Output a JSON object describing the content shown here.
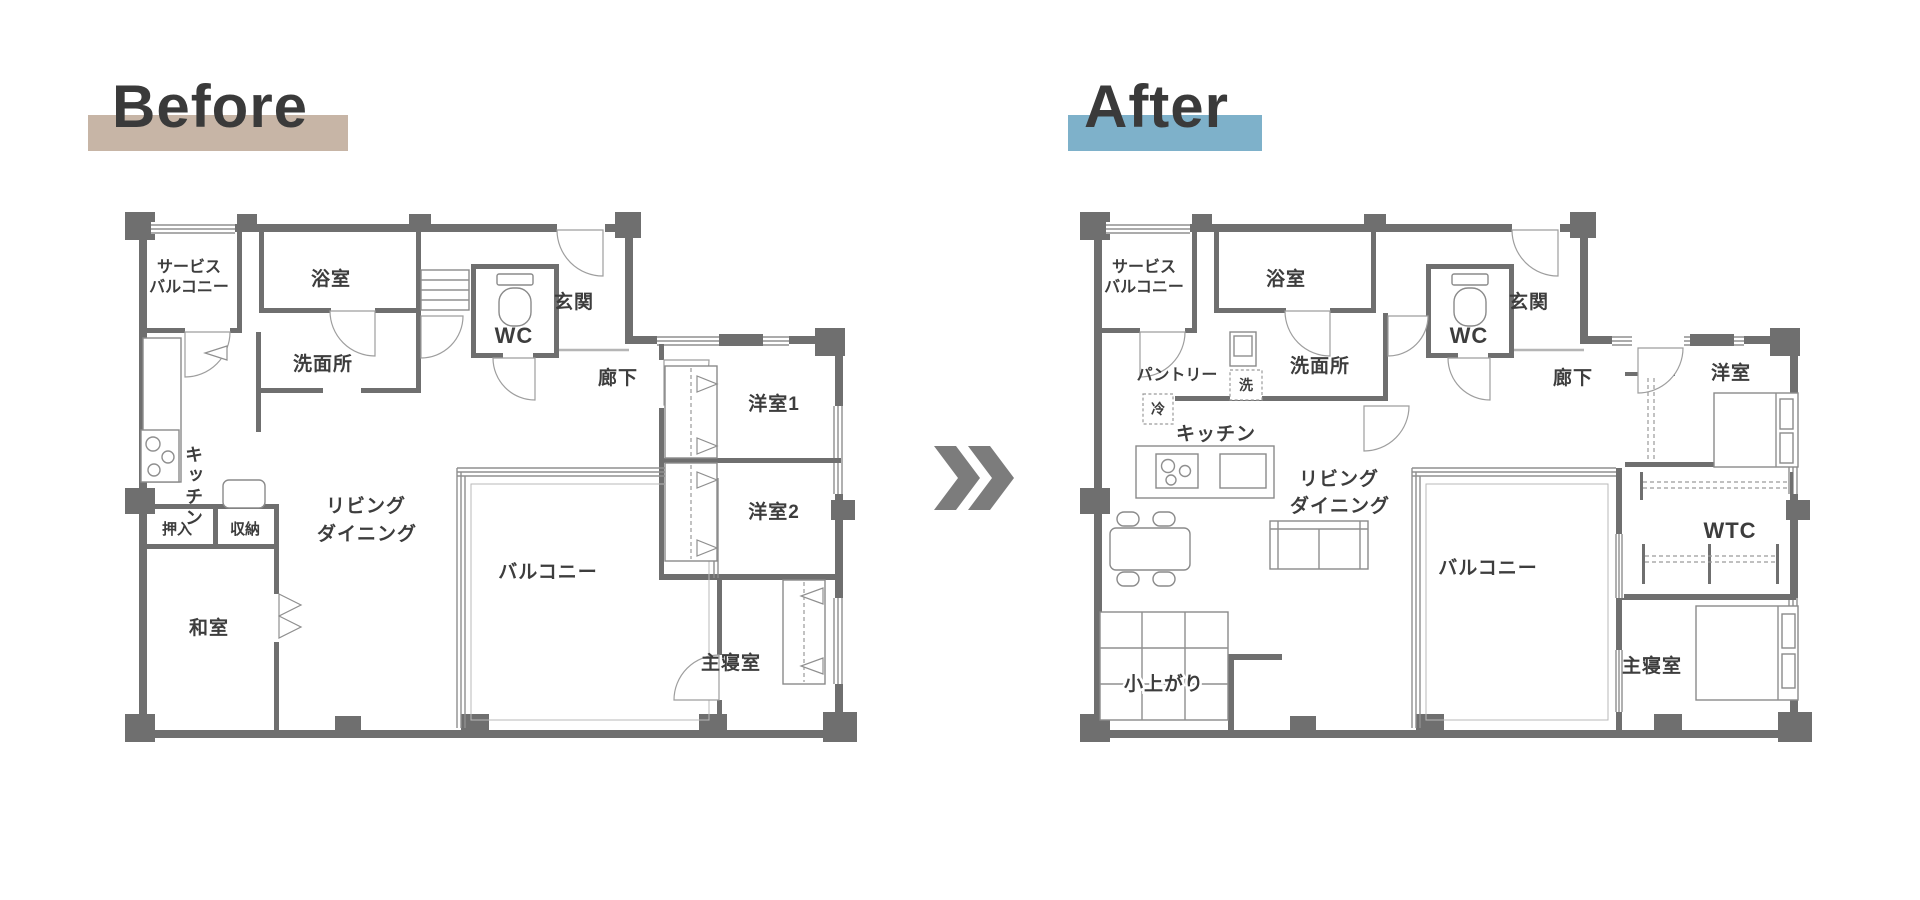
{
  "titles": {
    "before": "Before",
    "after": "After"
  },
  "colors": {
    "before_highlight": "#c7b5a6",
    "after_highlight": "#7eb1ca",
    "wall": "#6f6f6f",
    "chevron": "#7c7c7c",
    "label_text": "#3d3d3d"
  },
  "chevron": {
    "icon": "double-angle-right"
  },
  "before": {
    "rooms": {
      "service_balcony_1": "サービス",
      "service_balcony_2": "バルコニー",
      "bath": "浴室",
      "washroom": "洗面所",
      "wc": "WC",
      "entrance": "玄関",
      "hallway": "廊下",
      "kitchen": "キッチン",
      "western1": "洋室1",
      "western2": "洋室2",
      "living_1": "リビング",
      "living_2": "ダイニング",
      "oshiire": "押入",
      "shuno": "収納",
      "japanese_room": "和室",
      "balcony": "バルコニー",
      "master": "主寝室"
    }
  },
  "after": {
    "rooms": {
      "service_balcony_1": "サービス",
      "service_balcony_2": "バルコニー",
      "bath": "浴室",
      "pantry": "パントリー",
      "fridge": "冷",
      "washer": "洗",
      "washroom": "洗面所",
      "wc": "WC",
      "entrance": "玄関",
      "hallway": "廊下",
      "kitchen": "キッチン",
      "western": "洋室",
      "living_1": "リビング",
      "living_2": "ダイニング",
      "balcony": "バルコニー",
      "wtc": "WTC",
      "koagari": "小上がり",
      "master": "主寝室"
    }
  }
}
